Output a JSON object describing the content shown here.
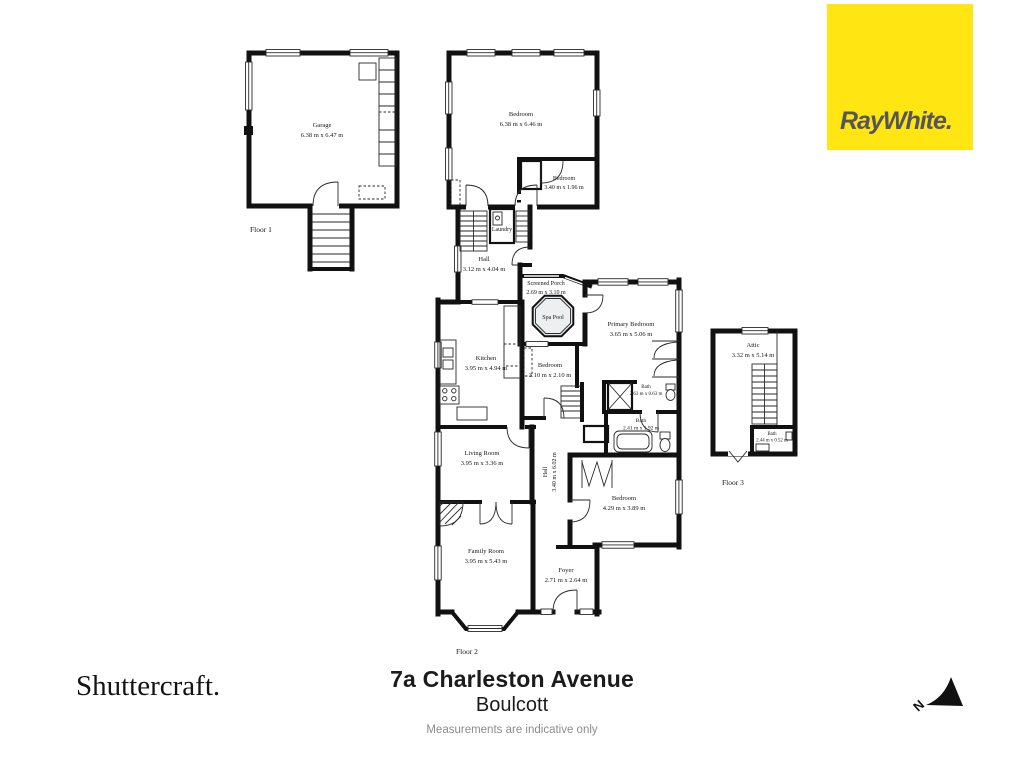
{
  "branding": {
    "agency_logo": "RayWhite.",
    "agency_bg_color": "#FFE512",
    "agency_text_color": "#54565B",
    "provider_logo": "Shuttercraft."
  },
  "footer": {
    "address": "7a Charleston Avenue",
    "suburb": "Boulcott",
    "disclaimer": "Measurements are indicative only"
  },
  "floors": {
    "floor1": "Floor 1",
    "floor2": "Floor 2",
    "floor3": "Floor 3"
  },
  "compass": {
    "north_label": "N"
  },
  "rooms": {
    "garage": {
      "name": "Garage",
      "dims": "6.38 m x 6.47 m"
    },
    "bedroom_f1_large": {
      "name": "Bedroom",
      "dims": "6.38 m x 6.46 m"
    },
    "bedroom_f1_small": {
      "name": "Bedroom",
      "dims": "3.40 m x 1.96 m"
    },
    "laundry": {
      "name": "Laundry",
      "dims": ""
    },
    "hall_upper": {
      "name": "Hall",
      "dims": "3.12 m x 4.04 m"
    },
    "screened_porch": {
      "name": "Screened Porch",
      "dims": "2.69 m x 3.10 m"
    },
    "spa_pool": {
      "name": "Spa Pool",
      "dims": ""
    },
    "primary_bedroom": {
      "name": "Primary Bedroom",
      "dims": "3.65 m x 5.06 m"
    },
    "kitchen": {
      "name": "Kitchen",
      "dims": "3.95 m x 4.94 m"
    },
    "bedroom_mid": {
      "name": "Bedroom",
      "dims": "3.10 m x 2.10 m"
    },
    "bath_small": {
      "name": "Bath",
      "dims": "2.63 m x 0.63 m"
    },
    "bath_main": {
      "name": "Bath",
      "dims": "2.41 m x 1.92 m"
    },
    "living_room": {
      "name": "Living Room",
      "dims": "3.95 m x 3.36 m"
    },
    "hall_lower": {
      "name": "Hall",
      "dims": "3.40 m x 6.02 m"
    },
    "bedroom_right": {
      "name": "Bedroom",
      "dims": "4.29 m x 3.89 m"
    },
    "family_room": {
      "name": "Family Room",
      "dims": "3.95 m x 5.43 m"
    },
    "foyer": {
      "name": "Foyer",
      "dims": "2.71 m x 2.64 m"
    },
    "attic": {
      "name": "Attic",
      "dims": "3.32 m x 5.14 m"
    },
    "bath_attic": {
      "name": "Bath",
      "dims": "2.44 m x 0.52 m"
    }
  }
}
